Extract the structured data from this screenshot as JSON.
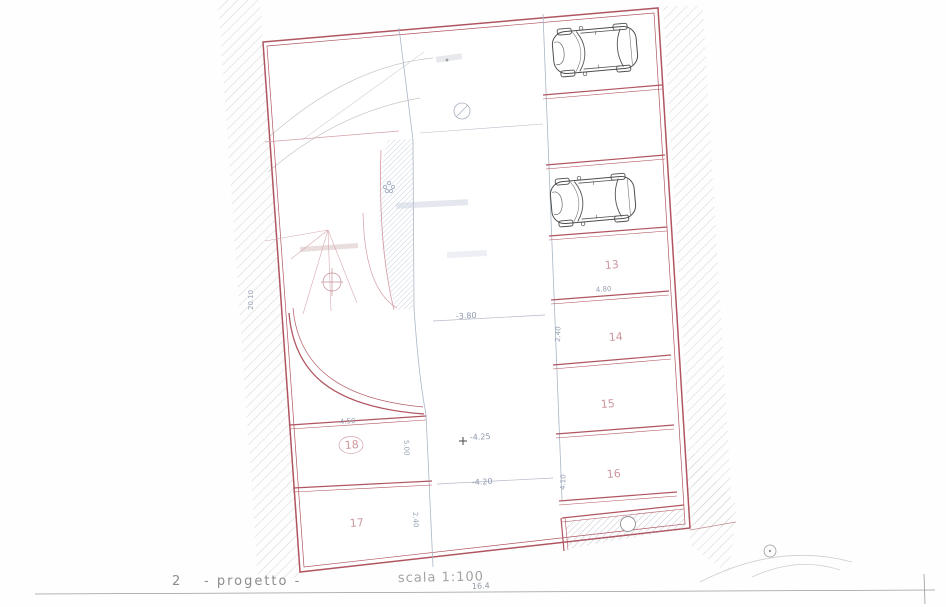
{
  "caption": {
    "index": "2",
    "title": "- progetto -",
    "scale": "scala 1:100"
  },
  "spaces": {
    "s13": "13",
    "s14": "14",
    "s15": "15",
    "s16": "16",
    "s17": "17",
    "s18": "18"
  },
  "dims": {
    "left_height": "20.10",
    "w18": "4.50",
    "d18": "5.00",
    "notch": "2.40",
    "bottom": "16.4",
    "w13": "4.80",
    "d14": "2.40",
    "d16": "4.10"
  },
  "levels": {
    "l1": "-3.80",
    "l2": "-4.25",
    "l3": "-4.20"
  },
  "colors": {
    "boundary_red": "#b05560",
    "light_pink": "#d4a0a6",
    "hatch_blue": "#a9b7cb",
    "hatch_gray": "#c9c9c9",
    "dim_gray": "#98a2b4",
    "label_pink": "#c2868d"
  }
}
